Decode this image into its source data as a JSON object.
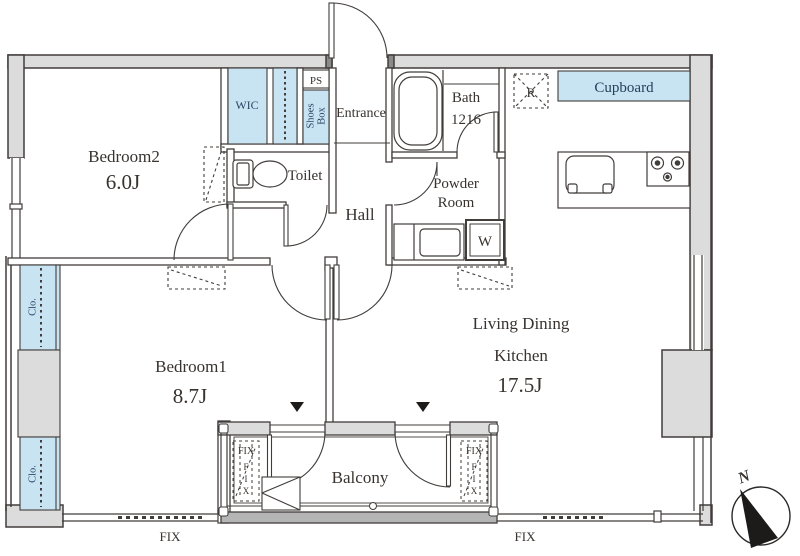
{
  "title": "Apartment floor plan 2LDK",
  "colors": {
    "wall_fill": "#dcdcdc",
    "line": "#413d3b",
    "accent_blue": "#c8e4f2",
    "label": "#38332f",
    "blue_text": "#2c4866",
    "balcony_rail": "#b5b5b5"
  },
  "rooms": {
    "bedroom2": {
      "name": "Bedroom2",
      "size": "6.0J"
    },
    "bedroom1": {
      "name": "Bedroom1",
      "size": "8.7J"
    },
    "ldk": {
      "line1": "Living Dining",
      "line2": "Kitchen",
      "size": "17.5J"
    },
    "hall": {
      "name": "Hall"
    },
    "entrance": {
      "name": "Entrance"
    },
    "toilet": {
      "name": "Toilet"
    },
    "bath": {
      "name": "Bath",
      "size": "1216"
    },
    "powder": {
      "line1": "Powder",
      "line2": "Room"
    },
    "balcony": {
      "name": "Balcony"
    }
  },
  "storage": {
    "wic": "WIC",
    "ps": "PS",
    "shoes_line1": "Shoes",
    "shoes_line2": "Box",
    "cupboard": "Cupboard",
    "closet1": "Clo.",
    "closet2": "Clo.",
    "washer": "W",
    "fridge": "R"
  },
  "windows": {
    "fix": "FIX",
    "fix_letters": {
      "f": "F",
      "i": "I",
      "x": "X"
    }
  },
  "compass": {
    "north": "N"
  }
}
